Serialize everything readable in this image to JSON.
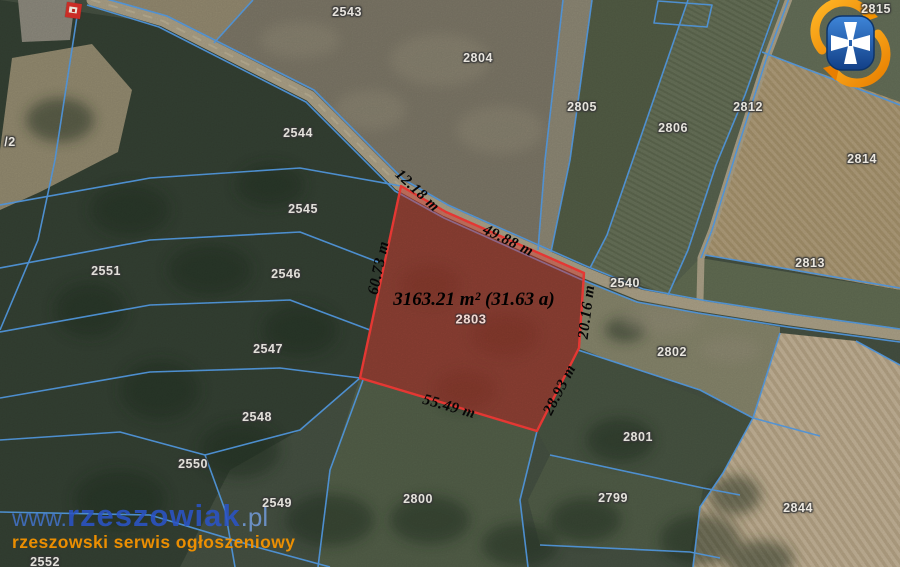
{
  "site": {
    "watermark_www": "www.",
    "watermark_name": "rzeszowiak",
    "watermark_tld": ".pl",
    "watermark_tagline": "rzeszowski serwis ogłoszeniowy"
  },
  "highlight": {
    "parcel_id": "2803",
    "area_label": "3163.21 m² (31.63 a)",
    "dimensions": [
      {
        "label": "12.18 m"
      },
      {
        "label": "49.88 m"
      },
      {
        "label": "60.73 m"
      },
      {
        "label": "20.16 m"
      },
      {
        "label": "28.93 m"
      },
      {
        "label": "55.49 m"
      }
    ]
  },
  "map": {
    "parcel_labels": [
      {
        "id": "2543"
      },
      {
        "id": "2804"
      },
      {
        "id": "2805"
      },
      {
        "id": "2806"
      },
      {
        "id": "2812"
      },
      {
        "id": "2815"
      },
      {
        "id": "2814"
      },
      {
        "id": "2813"
      },
      {
        "id": "2540"
      },
      {
        "id": "2544"
      },
      {
        "id": "2545"
      },
      {
        "id": "2546"
      },
      {
        "id": "2551"
      },
      {
        "id": "2547"
      },
      {
        "id": "2548"
      },
      {
        "id": "2550"
      },
      {
        "id": "2549"
      },
      {
        "id": "2552"
      },
      {
        "id": "/2"
      },
      {
        "id": "2800"
      },
      {
        "id": "2802"
      },
      {
        "id": "2801"
      },
      {
        "id": "2799"
      },
      {
        "id": "2844"
      }
    ]
  },
  "colors": {
    "boundary_line": "#4c8fd6",
    "highlight_fill": "rgba(214,52,42,0.45)",
    "highlight_stroke": "#e43531",
    "watermark_blue": "#2b54c6",
    "watermark_orange": "#f39200",
    "logo_shield_blue": "#1d5caa",
    "logo_arrow_orange": "#f59300"
  }
}
